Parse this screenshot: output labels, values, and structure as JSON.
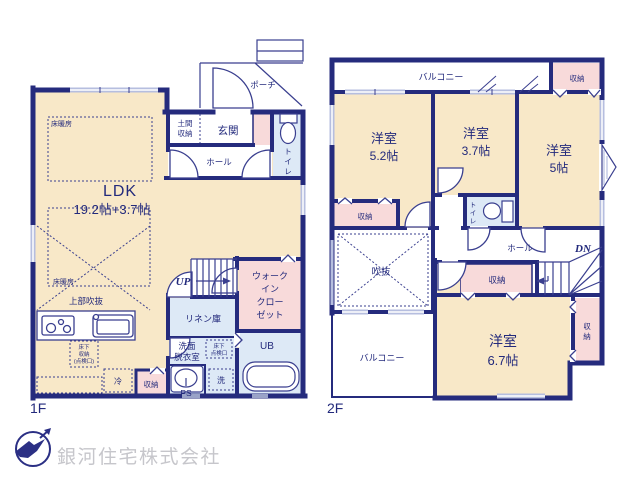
{
  "company": {
    "name": "銀河住宅株式会社"
  },
  "palette": {
    "wall_navy": "#252b7d",
    "room_beige": "#f8e8c8",
    "closet_pink": "#f8dada",
    "wet_blue": "#dde9f6",
    "window_gray": "#b6bedf",
    "text_navy": "#232a7c",
    "logo_text_gray": "#c6c6cb"
  },
  "floor1": {
    "label": "1F",
    "ldk_name": "LDK",
    "ldk_size": "19.2帖+3.7帖",
    "floor_heating_1": "床暖房",
    "floor_heating_2": "床暖房",
    "upper_void": "上部吹抜",
    "doma_storage": [
      "土間",
      "収納"
    ],
    "entrance": "玄関",
    "hall": "ホール",
    "porch": "ポーチ",
    "toilet_chars": [
      "ト",
      "イ",
      "レ"
    ],
    "stairs_up": "UP",
    "wic_lines": [
      "ウォーク",
      "イン",
      "クロー",
      "ゼット"
    ],
    "linen": "リネン庫",
    "washroom": [
      "洗面",
      "脱衣室"
    ],
    "underfloor_storage": [
      "床下",
      "収納",
      "(点検口)"
    ],
    "underfloor_hatch": [
      "床下",
      "点検口"
    ],
    "unit_bath": "UB",
    "laundry": "洗",
    "pipe_space": "PS",
    "fridge": "冷",
    "storage": "収納"
  },
  "floor2": {
    "label": "2F",
    "balcony_top": "バルコニー",
    "balcony_bottom": "バルコニー",
    "room_52_name": "洋室",
    "room_52_size": "5.2帖",
    "room_37_name": "洋室",
    "room_37_size": "3.7帖",
    "room_5_name": "洋室",
    "room_5_size": "5帖",
    "room_67_name": "洋室",
    "room_67_size": "6.7帖",
    "void": "吹抜",
    "hall": "ホール",
    "stairs_down": "DN",
    "toilet_chars": [
      "ト",
      "イ",
      "レ"
    ],
    "storage_top_right": "収納",
    "storage_left": "収納",
    "storage_center": "収納",
    "storage_right_chars": [
      "収",
      "納"
    ]
  }
}
